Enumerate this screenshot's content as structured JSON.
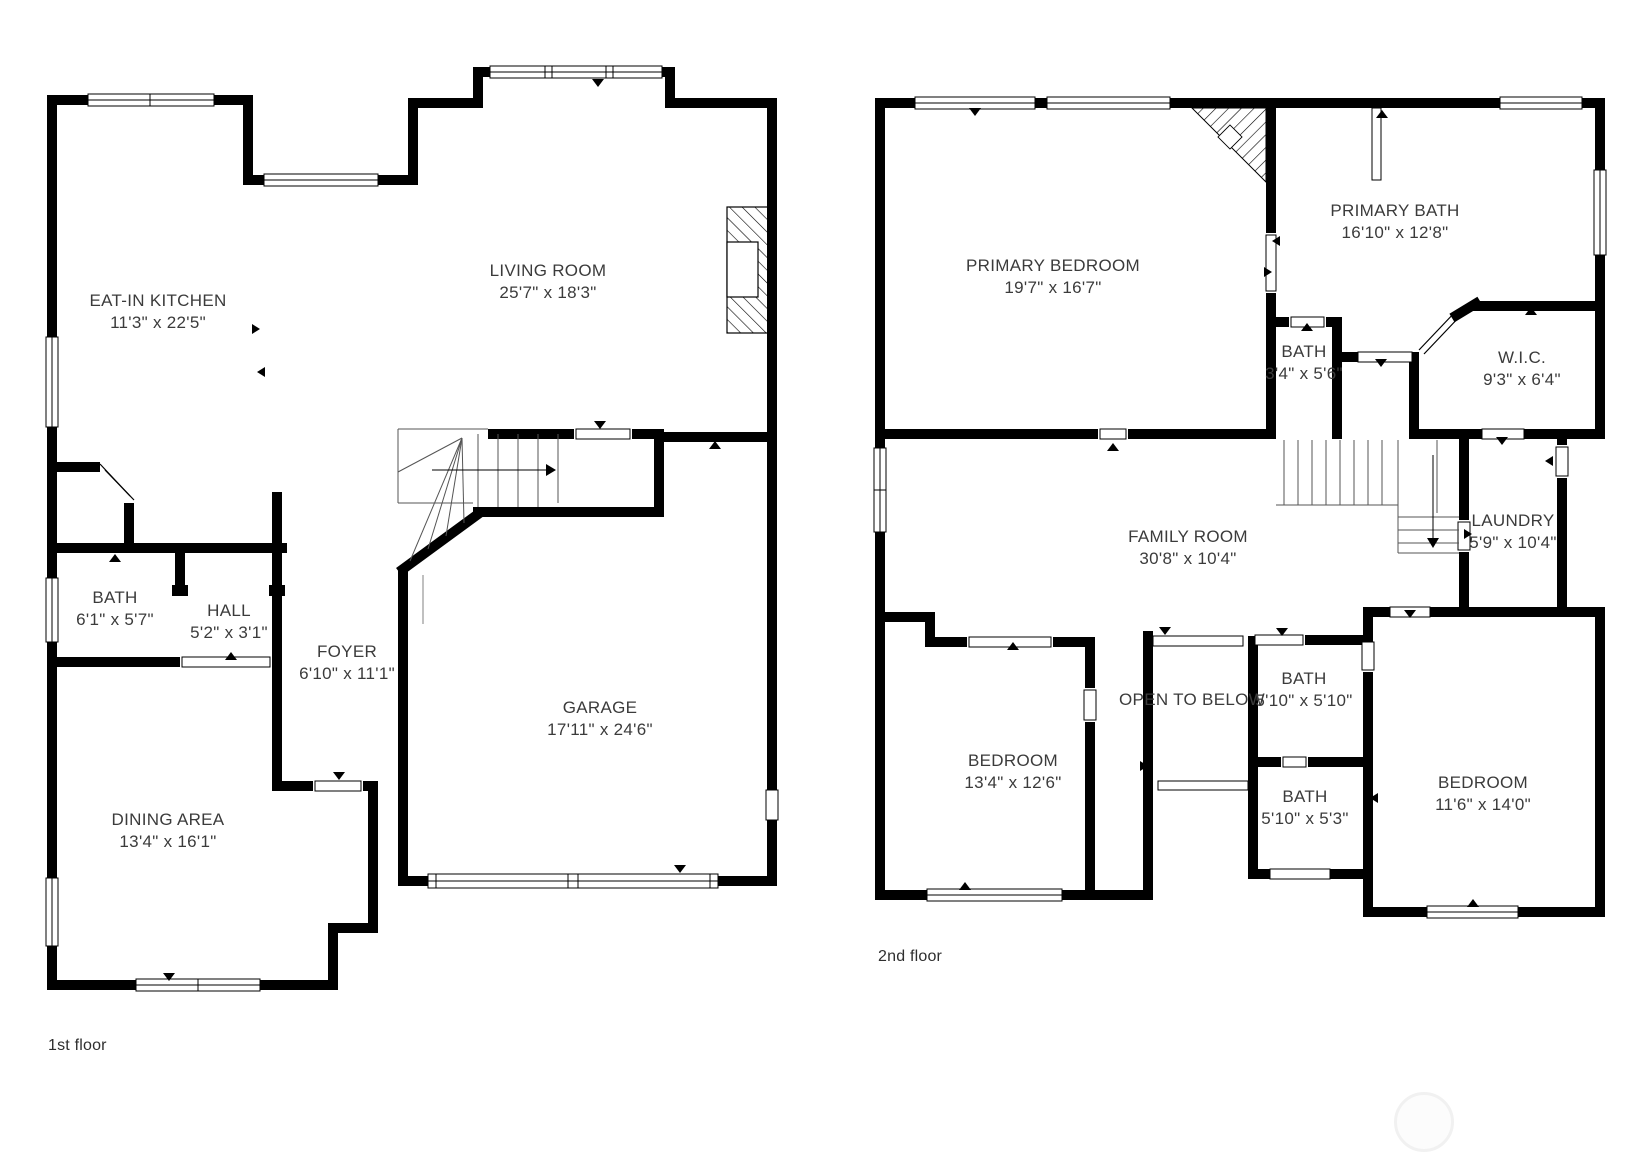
{
  "page": {
    "background": "#ffffff",
    "wall_color": "#000000",
    "text_color": "#3b3b3b"
  },
  "floors": [
    {
      "caption": "1st floor",
      "rooms": [
        {
          "name": "EAT-IN KITCHEN",
          "dims": "11'3\" x 22'5\""
        },
        {
          "name": "LIVING ROOM",
          "dims": "25'7\" x 18'3\""
        },
        {
          "name": "BATH",
          "dims": "6'1\" x 5'7\""
        },
        {
          "name": "HALL",
          "dims": "5'2\" x 3'1\""
        },
        {
          "name": "FOYER",
          "dims": "6'10\" x 11'1\""
        },
        {
          "name": "DINING AREA",
          "dims": "13'4\" x 16'1\""
        },
        {
          "name": "GARAGE",
          "dims": "17'11\" x 24'6\""
        }
      ]
    },
    {
      "caption": "2nd floor",
      "rooms": [
        {
          "name": "PRIMARY BEDROOM",
          "dims": "19'7\" x 16'7\""
        },
        {
          "name": "PRIMARY BATH",
          "dims": "16'10\" x 12'8\""
        },
        {
          "name": "BATH",
          "dims": "3'4\" x 5'6\""
        },
        {
          "name": "W.I.C.",
          "dims": "9'3\" x 6'4\""
        },
        {
          "name": "FAMILY ROOM",
          "dims": "30'8\" x 10'4\""
        },
        {
          "name": "LAUNDRY",
          "dims": "5'9\" x 10'4\""
        },
        {
          "name": "BEDROOM",
          "dims": "13'4\" x 12'6\""
        },
        {
          "name": "OPEN TO BELOW",
          "dims": ""
        },
        {
          "name": "BATH",
          "dims": "5'10\" x 5'10\""
        },
        {
          "name": "BATH",
          "dims": "5'10\" x 5'3\""
        },
        {
          "name": "BEDROOM",
          "dims": "11'6\" x 14'0\""
        }
      ]
    }
  ]
}
